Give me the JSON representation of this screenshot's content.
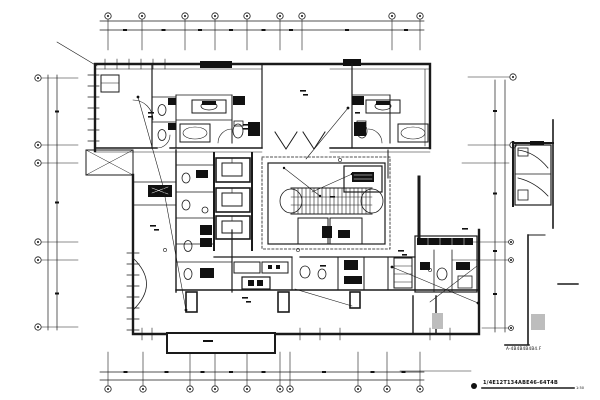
{
  "drawing": {
    "background_color": "#ffffff",
    "ink_color": "#1a1a1a",
    "gray_fill_color": "#bdbdbd",
    "title_text": "1/4E12T134ABE46-64T4B",
    "title_scale_text": "1:50",
    "note_text": "A-4B4B4B4B4.F"
  },
  "grids": {
    "top": {
      "bubble_y": 16,
      "line_y1": 21,
      "line_y2": 30,
      "stub_y2": 50,
      "x_start": 100,
      "x_end": 424,
      "xs": [
        108,
        142,
        185,
        215,
        247,
        280,
        302,
        392,
        420
      ]
    },
    "bottom": {
      "bubble_y": 389,
      "line_y1": 372,
      "line_y2": 380,
      "stub_y1": 352,
      "x_start": 100,
      "x_end": 424,
      "xs": [
        108,
        143,
        190,
        215,
        247,
        280,
        290,
        358,
        387,
        420
      ]
    },
    "left": {
      "bubble_x": 38,
      "line_x1": 48,
      "line_x2": 57,
      "leader_x2": 78,
      "y_start": 75,
      "y_end": 330,
      "ys": [
        78,
        145,
        163,
        242,
        260,
        327
      ]
    },
    "right": {
      "line_x1": 495,
      "line_x2": 505,
      "y_start": 80,
      "y_end": 332,
      "bubbles": [
        {
          "x": 513,
          "y": 77,
          "r": 3.2
        },
        {
          "x": 513,
          "y": 145,
          "r": 3.2
        },
        {
          "x": 511,
          "y": 242,
          "r": 2.4
        },
        {
          "x": 511,
          "y": 260,
          "r": 2.4
        },
        {
          "x": 511,
          "y": 328,
          "r": 2.4
        }
      ],
      "leaders": [
        [
          468,
          77,
          509
        ],
        [
          468,
          145,
          509
        ],
        [
          462,
          163,
          509
        ],
        [
          452,
          242,
          508
        ],
        [
          452,
          260,
          508
        ],
        [
          482,
          328,
          508
        ]
      ]
    }
  }
}
